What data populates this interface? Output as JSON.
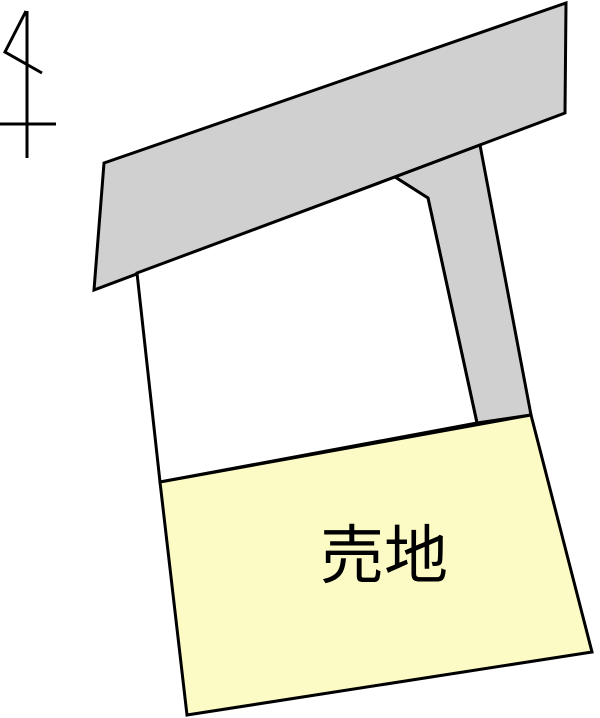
{
  "canvas": {
    "width": 600,
    "height": 718,
    "background": "#ffffff"
  },
  "colors": {
    "outline": "#000000",
    "road_fill": "#d0d0d0",
    "middle_plot_fill": "#ffffff",
    "sale_plot_fill": "#fcfac5",
    "label_color": "#000000"
  },
  "north_arrow": {
    "path": "M27 11 L27 158 M0 124 L56 124 M26 11 L5 52 L42 73",
    "stroke_width": 3
  },
  "parcels": {
    "road": {
      "name": "road",
      "points": "104,163 566,3 565,113 94,290",
      "stroke_width": 3
    },
    "strip": {
      "name": "flagpole strip",
      "points": "395,177 480,145 531,415 477,423 428,198",
      "stroke_width": 3
    },
    "middle_plot": {
      "name": "middle plot",
      "points": "137,273 395,177 428,198 477,423 160,482",
      "stroke_width": 3
    },
    "sale_plot": {
      "name": "sale plot",
      "points": "160,482 531,415 592,652 187,715",
      "stroke_width": 3
    }
  },
  "label": {
    "text": "売地",
    "x": 384,
    "y": 578,
    "font_size": 64
  }
}
